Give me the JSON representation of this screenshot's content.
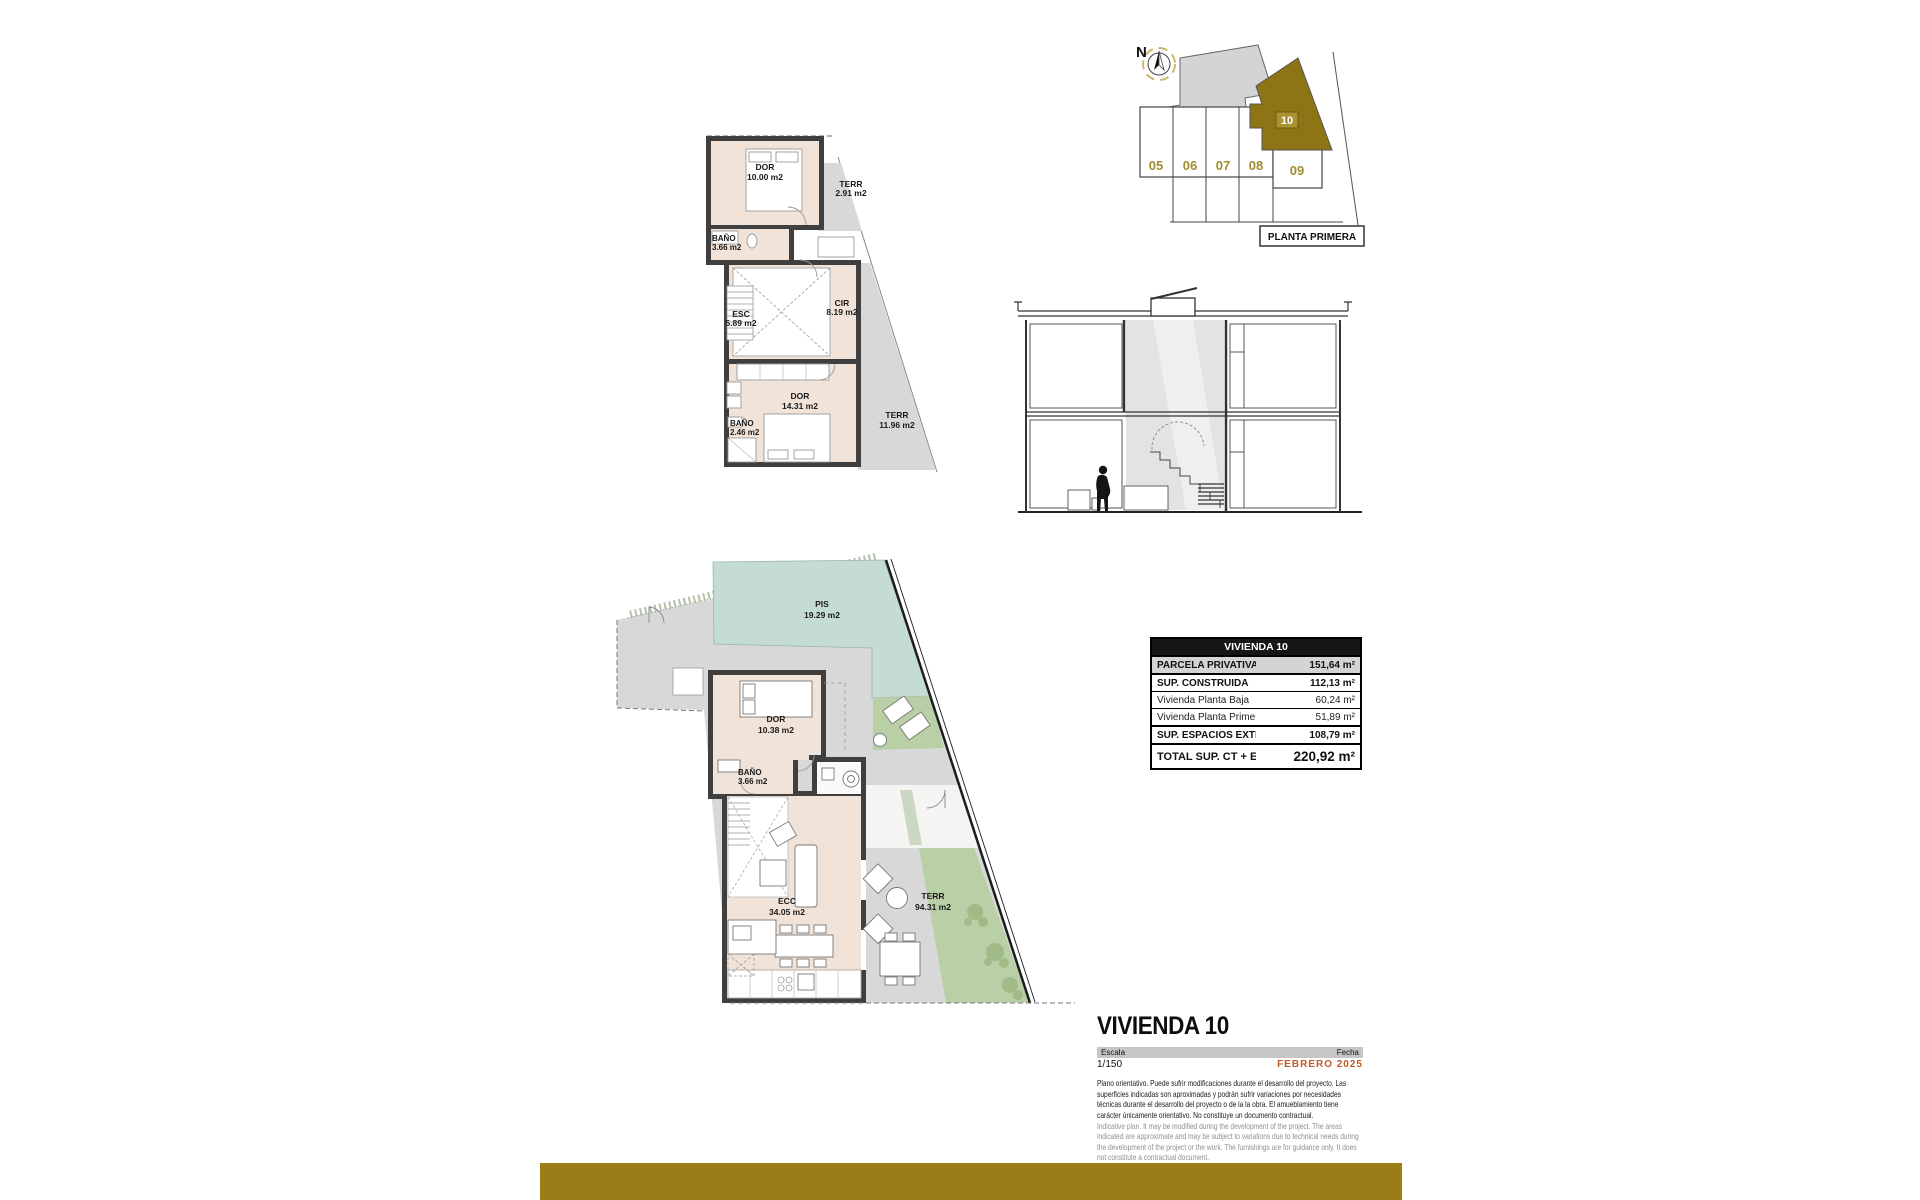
{
  "site_plan": {
    "north_label": "N",
    "caption": "PLANTA PRIMERA",
    "unit_numbers": [
      "05",
      "06",
      "07",
      "08",
      "09"
    ],
    "highlighted_unit": "10",
    "colors": {
      "highlight_fill": "#8d7414",
      "badge_fill": "#ab9233",
      "number_gold": "#a18c2e"
    }
  },
  "upper_plan": {
    "rooms": [
      {
        "name": "DOR",
        "area": "10.00 m2"
      },
      {
        "name": "TERR",
        "area": "2.91 m2"
      },
      {
        "name": "BAÑO",
        "area": "3.66 m2"
      },
      {
        "name": "ESC",
        "area": "5.89 m2"
      },
      {
        "name": "CIR",
        "area": "8.19 m2"
      },
      {
        "name": "DOR",
        "area": "14.31 m2"
      },
      {
        "name": "BAÑO",
        "area": "2.46 m2"
      },
      {
        "name": "TERR",
        "area": "11.96 m2"
      }
    ]
  },
  "ground_plan": {
    "rooms": [
      {
        "name": "PIS",
        "area": "19.29 m2"
      },
      {
        "name": "DOR",
        "area": "10.38 m2"
      },
      {
        "name": "BAÑO",
        "area": "3.66 m2"
      },
      {
        "name": "ECC",
        "area": "34.05 m2"
      },
      {
        "name": "TERR",
        "area": "94.31 m2"
      }
    ],
    "colors": {
      "pool": "#c5dcd5",
      "lawn": "#b9cfa6",
      "paving": "#d8d8d8",
      "room_fill": "#f1e3d8",
      "wall": "#3f3f3f"
    }
  },
  "area_table": {
    "title": "VIVIENDA 10",
    "rows": [
      {
        "label": "PARCELA PRIVATIVA",
        "value": "151,64 m²"
      },
      {
        "label": "SUP. CONSTRUIDA",
        "value": "112,13 m²"
      },
      {
        "label": "Vivienda Planta Baja",
        "value": "60,24 m²"
      },
      {
        "label": "Vivienda Planta Primera",
        "value": "51,89 m²"
      },
      {
        "label": "SUP. ESPACIOS EXTERIORES",
        "value": "108,79 m²"
      },
      {
        "label": "TOTAL SUP. CT + EXTERIOR",
        "value": "220,92 m²"
      }
    ]
  },
  "title_block": {
    "title": "VIVIENDA 10",
    "scale_label": "Escala",
    "scale_value": "1/150",
    "date_label": "Fecha",
    "date_value": "FEBRERO 2025",
    "date_color": "#c05a28",
    "disclaimer_es": "Plano orientativo. Puede sufrir modificaciones durante el desarrollo del proyecto. Las superficies indicadas son aproximadas y podrán sufrir variaciones por necesidades técnicas durante el desarrollo del proyecto o de la la obra. El amueblamiento tiene carácter únicamente orientativo. No constituye un documento contractual.",
    "disclaimer_en": "Indicative plan. It may be modified during the development of the project. The areas indicated are approximate and may be subject to variations due to technical needs during the development of the project or the work. The furnishings are for guidance only. It does not constitute a contractual document."
  },
  "brand": {
    "bar_color": "#9b7d17"
  }
}
